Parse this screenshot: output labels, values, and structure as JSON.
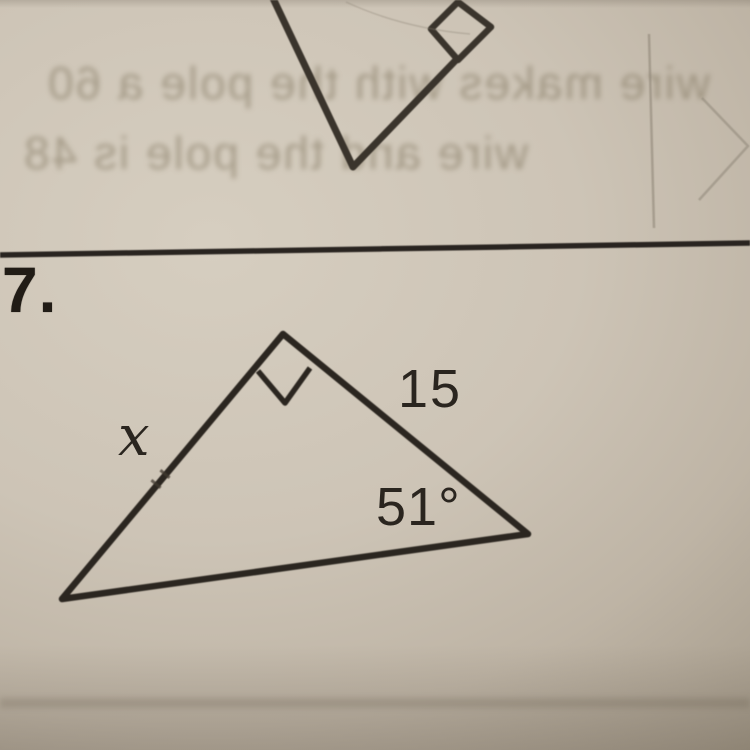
{
  "photo": {
    "kind": "photograph of a math worksheet page",
    "colors": {
      "paper_light": "#d6cec0",
      "paper_dark": "#90866f",
      "ink": "#2b2620",
      "pencil": "#8a8173"
    }
  },
  "problem": {
    "number": "7.",
    "figure": {
      "type": "right_triangle",
      "right_angle_at": "top vertex (marked with small square)",
      "side_labels": {
        "left_side": "x",
        "right_side": "15"
      },
      "angle_label": "51°"
    },
    "labels": {
      "unknown_side": "x",
      "hypotenuse": "15",
      "angle": "51°"
    }
  },
  "previous_problem": {
    "visible_part": "bottom vertex of a triangle with a right-angle square marker on its upper right side"
  },
  "bleed_through_text": {
    "line1": "wire makes with the pole a 60",
    "line2": "wire and the pole is 48"
  }
}
